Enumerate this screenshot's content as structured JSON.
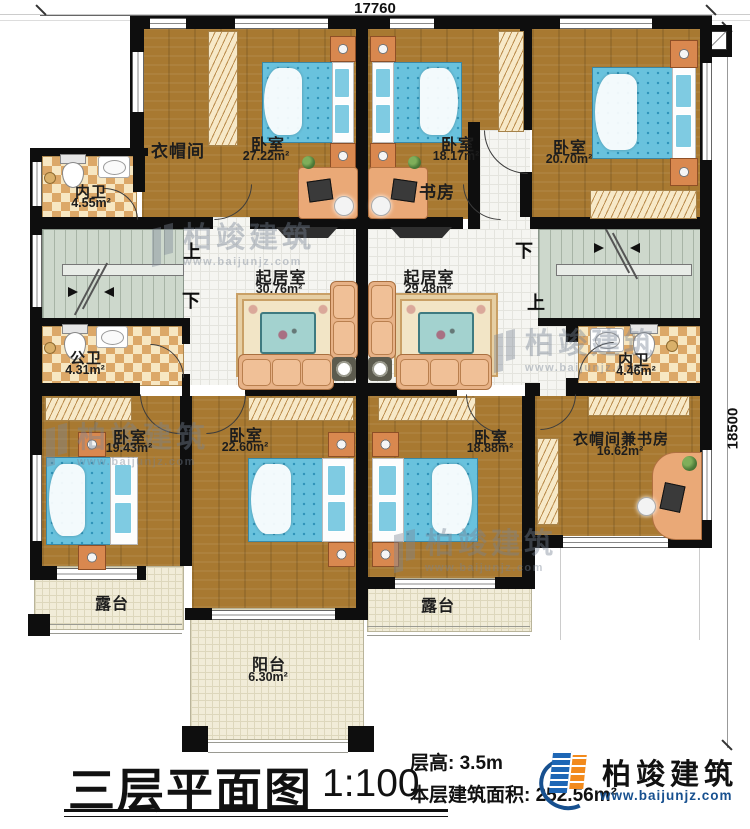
{
  "dimensions": {
    "top": "17760",
    "right": "18500"
  },
  "rooms": {
    "neiwei_tl": {
      "label": "内卫",
      "area": "4.55m²"
    },
    "yimaojian": {
      "label": "衣帽间"
    },
    "bedroom_tl": {
      "label": "卧室",
      "area": "27.22m²"
    },
    "bedroom_tm": {
      "label": "卧室",
      "area": "18.17m²"
    },
    "shufang": {
      "label": "书房"
    },
    "bedroom_tr": {
      "label": "卧室",
      "area": "20.70m²"
    },
    "living_left": {
      "label": "起居室",
      "area": "30.76m²"
    },
    "living_right": {
      "label": "起居室",
      "area": "29.48m²"
    },
    "gongwei": {
      "label": "公卫",
      "area": "4.31m²"
    },
    "neiwei_r": {
      "label": "内卫",
      "area": "4.46m²"
    },
    "bedroom_bl": {
      "label": "卧室",
      "area": "19.43m²"
    },
    "bedroom_bm": {
      "label": "卧室",
      "area": "22.60m²"
    },
    "bedroom_br": {
      "label": "卧室",
      "area": "18.88m²"
    },
    "cloak_study": {
      "label": "衣帽间兼书房",
      "area": "16.62m²"
    },
    "terrace_left": {
      "label": "露台"
    },
    "terrace_right": {
      "label": "露台"
    },
    "balcony": {
      "label": "阳台",
      "area": "6.30m²"
    }
  },
  "stairs": {
    "left": {
      "up": "上",
      "down": "下"
    },
    "right": {
      "up": "上",
      "down": "下"
    }
  },
  "title_block": {
    "title": "三层平面图",
    "scale": "1:100",
    "floor_height": "层高: 3.5m",
    "floor_area": "本层建筑面积: 252.56m²"
  },
  "brand": {
    "name": "柏竣建筑",
    "website": "www.baijunjz.com"
  },
  "colors": {
    "wall": "#0e0e0e",
    "wood_floor": "#a87931",
    "tile_floor": "#f5f5f1",
    "stair_floor": "#cdd8cc",
    "bath_tile": "#f7e7c2",
    "outdoor_floor": "#f1ecd8",
    "bed_blue": "#69c2dd",
    "furniture_tan": "#e7b287",
    "logo_blue": "#1d66b5",
    "logo_orange": "#f28a1c",
    "url_blue": "#17508f"
  }
}
